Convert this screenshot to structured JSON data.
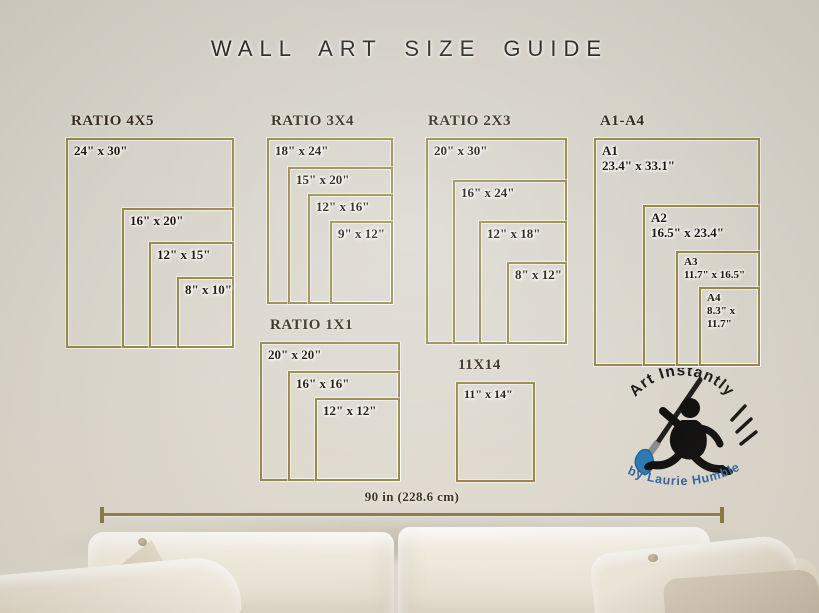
{
  "title": "WALL ART SIZE GUIDE",
  "groups": [
    {
      "id": "ratio-4x5",
      "heading": "RATIO 4X5",
      "sizes": [
        "24\" x 30\"",
        "16\" x 20\"",
        "12\" x 15\"",
        "8\" x 10\""
      ]
    },
    {
      "id": "ratio-3x4",
      "heading": "RATIO 3X4",
      "sizes": [
        "18\" x 24\"",
        "15\" x 20\"",
        "12\" x 16\"",
        "9\" x 12\""
      ]
    },
    {
      "id": "ratio-2x3",
      "heading": "RATIO 2X3",
      "sizes": [
        "20\" x 30\"",
        "16\" x 24\"",
        "12\" x 18\"",
        "8\" x 12\""
      ]
    },
    {
      "id": "a1-a4",
      "heading": "A1-A4",
      "sizes": [
        [
          "A1",
          "23.4\" x 33.1\""
        ],
        [
          "A2",
          "16.5\" x 23.4\""
        ],
        [
          "A3",
          "11.7\" x 16.5\""
        ],
        [
          "A4",
          "8.3\" x",
          "11.7\""
        ]
      ]
    },
    {
      "id": "ratio-1x1",
      "heading": "RATIO 1X1",
      "sizes": [
        "20\" x 20\"",
        "16\" x 16\"",
        "12\" x 12\""
      ]
    },
    {
      "id": "11x14",
      "heading": "11X14",
      "sizes": [
        "11\" x 14\""
      ]
    }
  ],
  "measure": {
    "label": "90 in (228.6 cm)"
  },
  "logo": {
    "arc_top": "Art Instantly",
    "arc_bottom": "by Laurie Humble"
  },
  "colors": {
    "frame_gold": "#97894a",
    "heading_text": "#33281a",
    "label_text": "#1c1309",
    "title_text": "#2f2d28",
    "measure_text": "#3e3421",
    "logo_blue": "#3465a0",
    "brush_blue": "#2d7ab7",
    "wall": "#d9d5cc"
  }
}
